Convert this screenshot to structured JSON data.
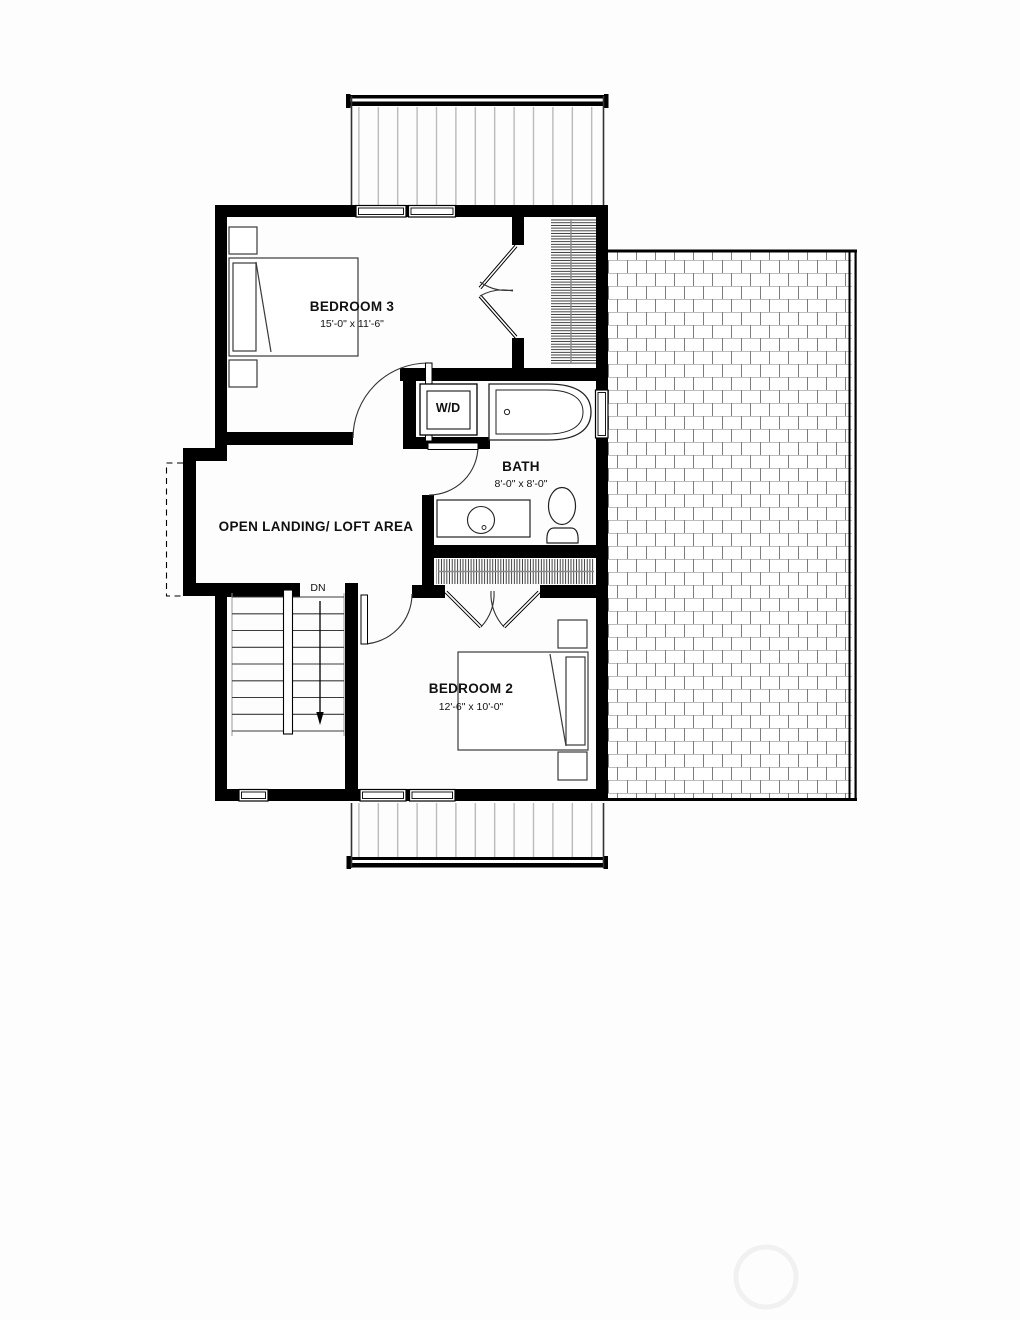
{
  "plan": {
    "type": "floor-plan",
    "rooms": {
      "bedroom3": {
        "name": "BEDROOM 3",
        "dims": "15'-0\" x 11'-6\""
      },
      "bath": {
        "name": "BATH",
        "dims": "8'-0\" x 8'-0\""
      },
      "landing": {
        "name": "OPEN LANDING/ LOFT AREA"
      },
      "bedroom2": {
        "name": "BEDROOM 2",
        "dims": "12'-6\" x 10'-0\""
      }
    },
    "labels": {
      "washer_dryer": "W/D",
      "stair_direction": "DN"
    },
    "colors": {
      "walls": "#000000",
      "deck_stripes": "#b0b0b0",
      "brick_horizontal_joints": "#bdbdbd",
      "brick_vertical_joints": "#7d7d7d",
      "hatch": "#222222",
      "background": "#fdfdfd",
      "watermark": "#f1f1f1"
    }
  }
}
